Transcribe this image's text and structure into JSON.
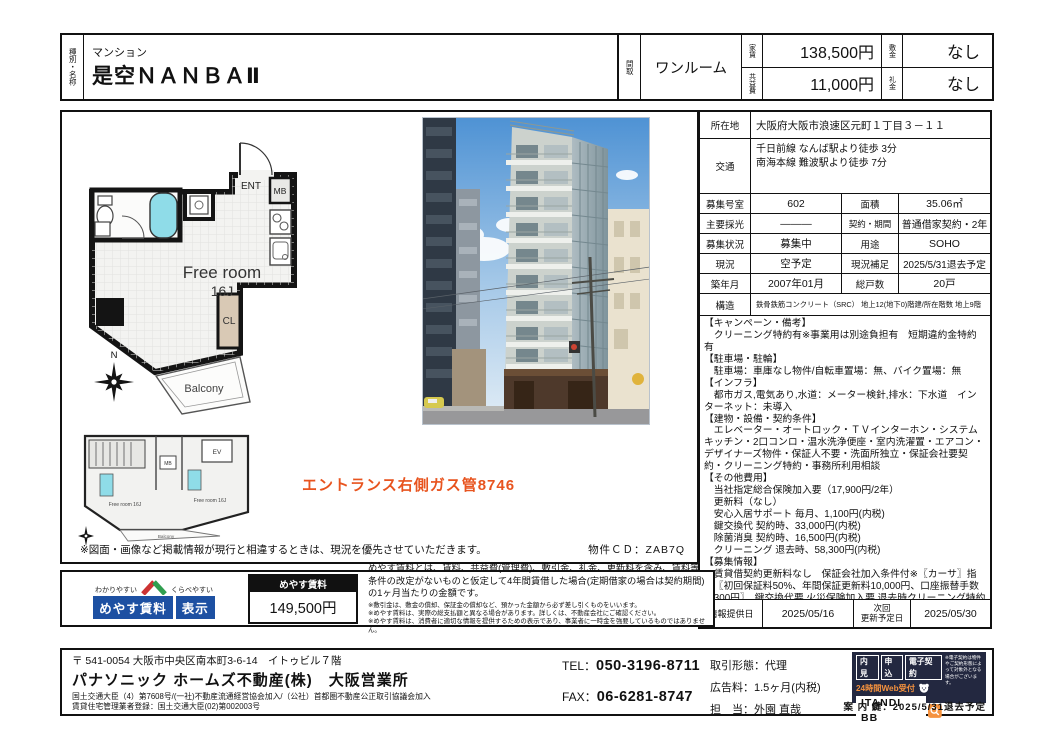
{
  "colors": {
    "accent_red": "#e8541f",
    "meyasu_blue": "#1d50a2",
    "roof_red": "#cc3333",
    "roof_green": "#2f9e4f",
    "itandi_bg": "#232840",
    "itandi_orange": "#f5923e",
    "bath_cyan": "#8fdce8",
    "closet_tan": "#d9c9b5"
  },
  "header": {
    "type_label": "種別・名称",
    "property_type": "マンション",
    "property_name": "是空ＮＡＮＢＡⅡ",
    "layout_label": "間取",
    "layout": "ワンルーム",
    "rent_label": "家賃",
    "rent": "138,500円",
    "fee_label": "共益費",
    "fee": "11,000円",
    "deposit_label": "敷金",
    "deposit": "なし",
    "key_money_label": "礼金",
    "key_money": "なし"
  },
  "floorplan": {
    "room": "Free room",
    "size": "16J",
    "ent": "ENT",
    "mb": "MB",
    "cl": "CL",
    "balcony": "Balcony",
    "north": "N"
  },
  "small_plan": {
    "ev": "EV",
    "mb": "MB",
    "room1": "Free room 16J",
    "room2": "Free room 16J",
    "balcony": "Balcony"
  },
  "main_panel": {
    "photo_note": "エントランス右側ガス管8746",
    "disclaimer": "※図面・画像など掲載情報が現行と相違するときは、現況を優先させていただきます。",
    "property_cd": "物件ＣＤ：ZAB7Q"
  },
  "details": {
    "location_label": "所在地",
    "location": "大阪府大阪市浪速区元町１丁目３－１１",
    "access_label": "交通",
    "access_line1": "千日前線 なんば駅より徒歩 3分",
    "access_line2": "南海本線 難波駅より徒歩 7分",
    "rows": [
      {
        "l1": "募集号室",
        "v1": "602",
        "l2": "面積",
        "v2": "35.06㎡"
      },
      {
        "l1": "主要採光",
        "v1": "―――",
        "l2": "契約・期間",
        "v2": "普通借家契約・2年"
      },
      {
        "l1": "募集状況",
        "v1": "募集中",
        "l2": "用途",
        "v2": "SOHO"
      },
      {
        "l1": "現況",
        "v1": "空予定",
        "l2": "現況補足",
        "v2": "2025/5/31退去予定"
      },
      {
        "l1": "築年月",
        "v1": "2007年01月",
        "l2": "総戸数",
        "v2": "20戸"
      }
    ],
    "structure_label": "構造",
    "structure": "鉄骨鉄筋コンクリート（SRC） 地上12(地下0)階建/所在階数 地上9階",
    "notes": [
      "【キャンペーン・備考】",
      "　クリーニング特約有※事業用は別途負担有　短期違約金特約有",
      "【駐車場・駐輪】",
      "　駐車場：車庫なし物件/自転車置場：無、バイク置場：無",
      "【インフラ】",
      "　都市ガス,電気あり,水道：メーター検針,排水：下水道　インターネット：未導入",
      "【建物・設備・契約条件】",
      "　エレベーター・オートロック・ＴＶインターホン・システムキッチン・2口コンロ・温水洗浄便座・室内洗濯置・エアコン・デザイナーズ物件・保証人不要・洗面所独立・保証会社要契約・クリーニング特約・事務所利用相談",
      "【その他費用】",
      "　当社指定総合保険加入要（17,900円/2年）",
      "　更新料（なし）",
      "　安心入居サポート 毎月、1,100円(内税)",
      "　鍵交換代 契約時、33,000円(内税)",
      "　除菌消臭 契約時、16,500円(内税)",
      "　クリーニング 退去時、58,300円(内税)",
      "【募集情報】",
      "　賃貸借契約更新料なし　保証会社加入条件付※〖カーサ〗指定〖初回保証料50%、年間保証更新料10,000円、口座振替手数料300円〗　鍵交換代要 火災保険加入要 退去時クリーニング特約有 短期解約違約金特約有（1年未満で家賃2ヶ月分発生）入居前室内除菌消臭費要　安心入居サポート加入要1,100円／月",
      "※事業用での契約の場合は条件が異なります。お問い合わせ下さい。"
    ],
    "info_date_label": "情報提供日",
    "info_date": "2025/05/16",
    "next_update_label": "次回\n更新予定日",
    "next_update": "2025/05/30"
  },
  "meyasu": {
    "tagline_left": "わかりやすい",
    "tagline_right": "くらべやすい",
    "logo_main": "めやす賃料",
    "logo_sub": "表示",
    "price_label": "めやす賃料",
    "price": "149,500円",
    "description": "めやす賃料とは、賃料、共益費(管理費)、敷引金、礼金、更新料を含み、賃料等条件の改定がないものと仮定して4年間賃借した場合(定期借家の場合は契約期間)の1ヶ月当たりの金額です。",
    "notes": [
      "※敷引金は、敷金の償却、保証金の償却など、預かった金額から必ず差し引くものをいいます。",
      "※めやす賃料は、実際の総支払額と異なる場合があります。詳しくは、不動産会社にご確認ください。",
      "※めやす賃料は、消費者に適切な情報を提供するための表示であり、事業者に一時金を強要しているものではありません。"
    ]
  },
  "footer": {
    "postal_address": "〒 541-0054 大阪市中央区南本町3-6-14　イトゥビル７階",
    "company": "パナソニック ホームズ不動産(株)　大阪営業所",
    "license1": "国土交通大臣（4）第7608号/(一社)不動産流通経営協会加入/（公社）首都圏不動産公正取引協議会加入",
    "license2": "賃貸住宅管理業者登録：国土交通大臣(02)第002003号",
    "tel_label": "TEL：",
    "tel": "050-3196-8711",
    "fax_label": "FAX：",
    "fax": "06-6281-8747",
    "deal_type_label": "取引形態：",
    "deal_type": "代理",
    "ad_fee_label": "広告料：",
    "ad_fee": "1.5ヶ月(内税)",
    "agent_label": "担　当：",
    "agent": "外園 直哉",
    "itandi": {
      "tabs": [
        "内見",
        "申込",
        "電子契約"
      ],
      "web_label": "24時間Web受付",
      "brand": "ITANDI BB",
      "note": "※電子契約は物件やご契約形態によって対象外となる場合がございます。",
      "key_info": "案 内 鍵：2025/5/31退去予定"
    }
  }
}
